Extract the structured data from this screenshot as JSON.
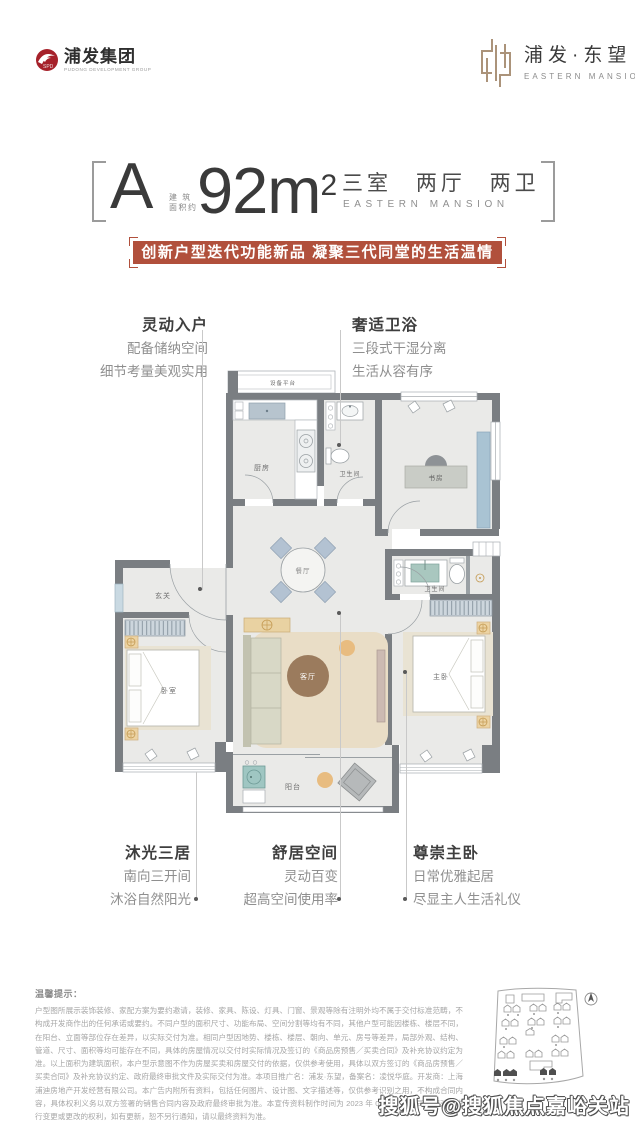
{
  "header": {
    "group_logo": {
      "name": "浦发集团",
      "tagline": "PUDONG DEVELOPMENT GROUP"
    },
    "project_logo": {
      "name": "浦发·东望",
      "tagline": "EASTERN MANSION"
    }
  },
  "title": {
    "unit_label": "A",
    "area_prefix_line1": "建 筑",
    "area_prefix_line2": "面积约",
    "area_value": "92m",
    "area_superscript": "2",
    "rooms_cn": "三室 两厅 两卫",
    "rooms_en": "EASTERN MANSION"
  },
  "banner": {
    "text": "创新户型迭代功能新品 凝聚三代同堂的生活温情",
    "color": "#b1503c"
  },
  "callouts": {
    "top_left": {
      "title": "灵动入户",
      "lines": [
        "配备储纳空间",
        "细节考量美观实用"
      ]
    },
    "top_right": {
      "title": "奢适卫浴",
      "lines": [
        "三段式干湿分离",
        "生活从容有序"
      ]
    },
    "bottom_left": {
      "title": "沐光三居",
      "lines": [
        "南向三开间",
        "沐浴自然阳光"
      ]
    },
    "bottom_center": {
      "title": "舒居空间",
      "lines": [
        "灵动百变",
        "超高空间使用率"
      ]
    },
    "bottom_right": {
      "title": "尊崇主卧",
      "lines": [
        "日常优雅起居",
        "尽显主人生活礼仪"
      ]
    }
  },
  "floorplan": {
    "wall_color": "#7a7e82",
    "floor_color": "#eaeae8",
    "rooms": [
      {
        "id": "equipment-platform",
        "label": "设备平台"
      },
      {
        "id": "kitchen",
        "label": "厨房"
      },
      {
        "id": "bath-1",
        "label": "卫生间"
      },
      {
        "id": "study",
        "label": "书房"
      },
      {
        "id": "foyer",
        "label": "玄关"
      },
      {
        "id": "dining",
        "label": "餐厅"
      },
      {
        "id": "bath-2",
        "label": "卫生间"
      },
      {
        "id": "bedroom",
        "label": "卧室"
      },
      {
        "id": "living",
        "label": "客厅"
      },
      {
        "id": "master-bedroom",
        "label": "主卧"
      },
      {
        "id": "balcony",
        "label": "阳台"
      }
    ]
  },
  "disclaimer": {
    "title": "温馨提示：",
    "body": "户型图所展示装饰装修、家配方案为要约邀请，装修、家具、陈设、灯具、门窗、景观等除有注明外均不属于交付标准范畴，不构成开发商作出的任何承诺或要约。不同户型的面积尺寸、功能布局、空间分割等均有不同，其他户型可能因楼栋、楼层不同，在阳台、立面等部位存在差异，以实际交付为准。相同户型因地势、楼栋、楼层、朝向、单元、房号等差异，局部外观、结构、管道、尺寸、面积等均可能存在不同，具体的房屋情况以交付时实际情况及签订的《商品房预售／买卖合同》及补充协议约定为准。以上面积为建筑面积，本户型示意图不作为房屋买卖和房屋交付的依据，仅供参考使用，具体以双方签订的《商品房预售／买卖合同》及补充协议约定、政府最终审批文件及实际交付为准。本项目推广名：浦发·东望，备案名：凌悦华庭。开发商：上海浦迪房地产开发经营有限公司。本广告内附所有资料，包括任何图片、设计图、文字描述等，仅供参考识别之用，不构成合同内容，具体权利义务以双方签署的销售合同内容及政府最终审批为准。本宣传资料制作时间为 2023 年 08 月，本公司保留对其进行变更或更改的权利，如有更新，恕不另行通知，请以最终资料为准。"
  },
  "watermark": {
    "text": "搜狐号@搜狐焦点嘉峪关站"
  }
}
